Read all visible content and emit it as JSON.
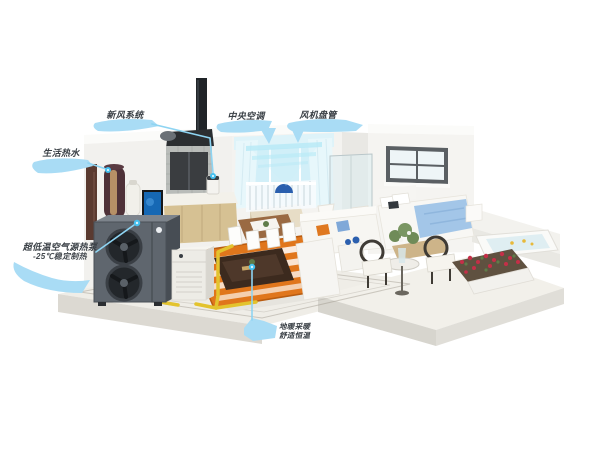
{
  "diagram_title": "whole-home air-source heat pump system cutaway",
  "labels": {
    "fresh_air": "新风系统",
    "central_ac": "中央空调",
    "fan_coil": "风机盘管",
    "hot_water": "生活热水",
    "heat_pump_line1": "超低温空气源热泵",
    "heat_pump_line2": "-25℃稳定制热",
    "floor_heating_line1": "地暖采暖",
    "floor_heating_line2": "舒适恒温"
  },
  "colors": {
    "label_text": "#3a4046",
    "swoosh_blue": "#a9dcf5",
    "connector_blue": "#8ed4f2",
    "dot_blue": "#45c0ef",
    "floor_heating_orange": "#e0761c",
    "pipe_yellow": "#e3c32e",
    "airflow_cyan": "#b5e9f6",
    "fresh_air_green": "#4ec94e"
  }
}
